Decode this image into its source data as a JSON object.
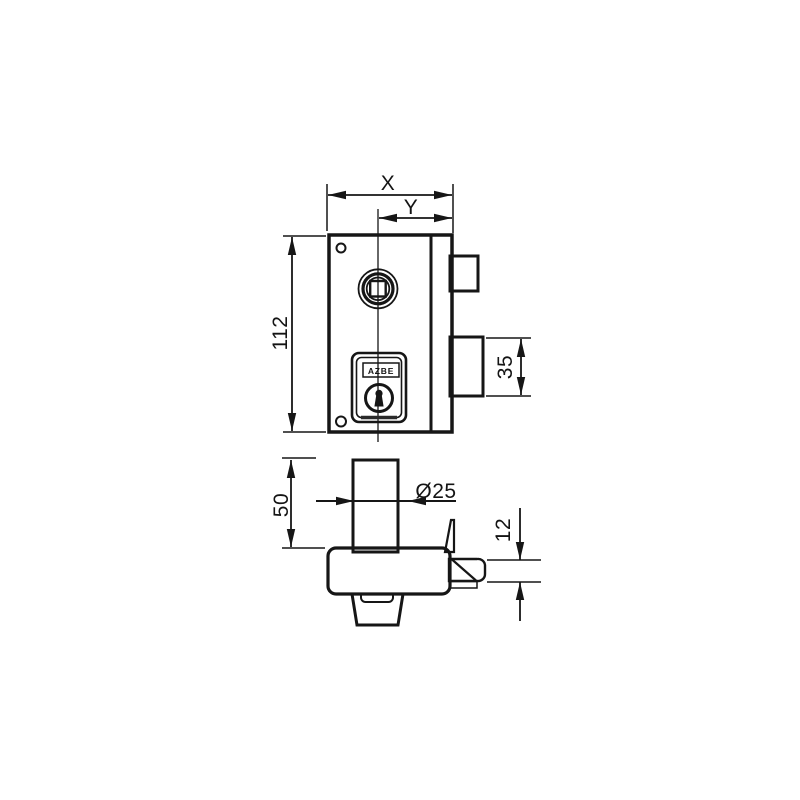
{
  "drawing": {
    "type": "lock-technical-drawing",
    "front_view": {
      "brand": "AZBE",
      "dimensions": {
        "width": "X",
        "backset": "Y",
        "body_height": "112",
        "deadbolt_height": "35"
      }
    },
    "side_view": {
      "dimensions": {
        "cylinder_height": "50",
        "cylinder_diameter": "Ø25",
        "latch_height": "12"
      }
    },
    "colors": {
      "background": "#ffffff",
      "line": "#161616",
      "body_fill": "#dadada",
      "stipple_dot": "#8c8c8c",
      "hatch_dark": "#222222"
    }
  }
}
